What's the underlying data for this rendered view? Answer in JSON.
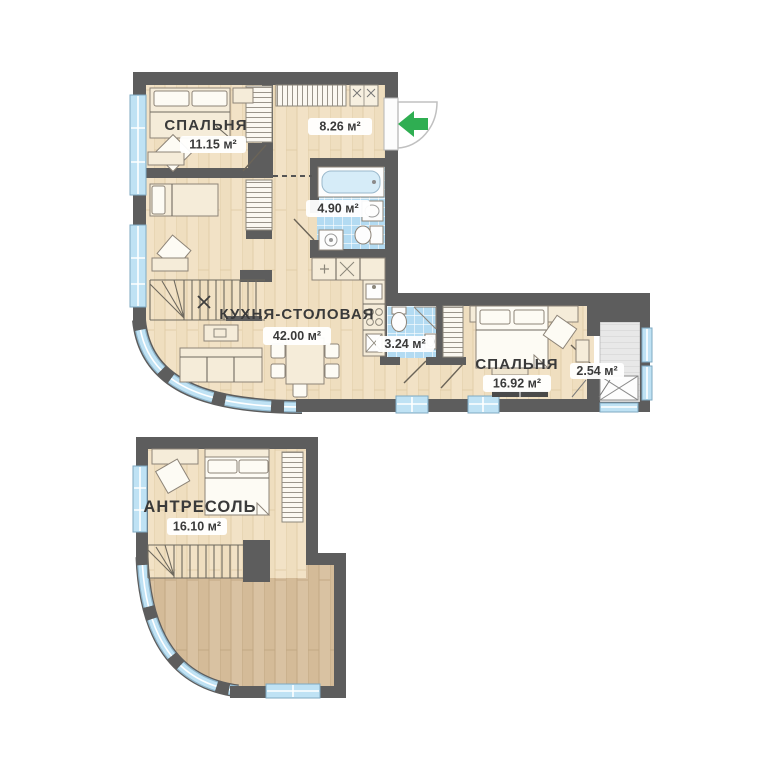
{
  "plans": {
    "upper": {
      "rooms": [
        {
          "id": "bedroom-1",
          "label": "СПАЛЬНЯ",
          "area": "11.15 м²"
        },
        {
          "id": "hallway",
          "label": "",
          "area": "8.26 м²"
        },
        {
          "id": "bathroom-main",
          "label": "",
          "area": "4.90 м²"
        },
        {
          "id": "kitchen-dining",
          "label": "КУХНЯ-СТОЛОВАЯ",
          "area": "42.00 м²"
        },
        {
          "id": "bathroom-small",
          "label": "",
          "area": "3.24 м²"
        },
        {
          "id": "bedroom-2",
          "label": "СПАЛЬНЯ",
          "area": "16.92 м²"
        },
        {
          "id": "balcony",
          "label": "",
          "area": "2.54 м²"
        }
      ]
    },
    "lower": {
      "rooms": [
        {
          "id": "mezzanine",
          "label": "АНТРЕСОЛЬ",
          "area": "16.10 м²"
        }
      ]
    }
  },
  "colors": {
    "wall": "#5d5d5d",
    "floor_light": "#f2e2c6",
    "floor_dark": "#d9c2a2",
    "window_glass": "#bfe2f4",
    "bathroom_tile": "#b3dbf2",
    "entrance_arrow_green": "#2fae52",
    "label_text": "#3a3a3a",
    "badge_background": "#ffffff"
  }
}
